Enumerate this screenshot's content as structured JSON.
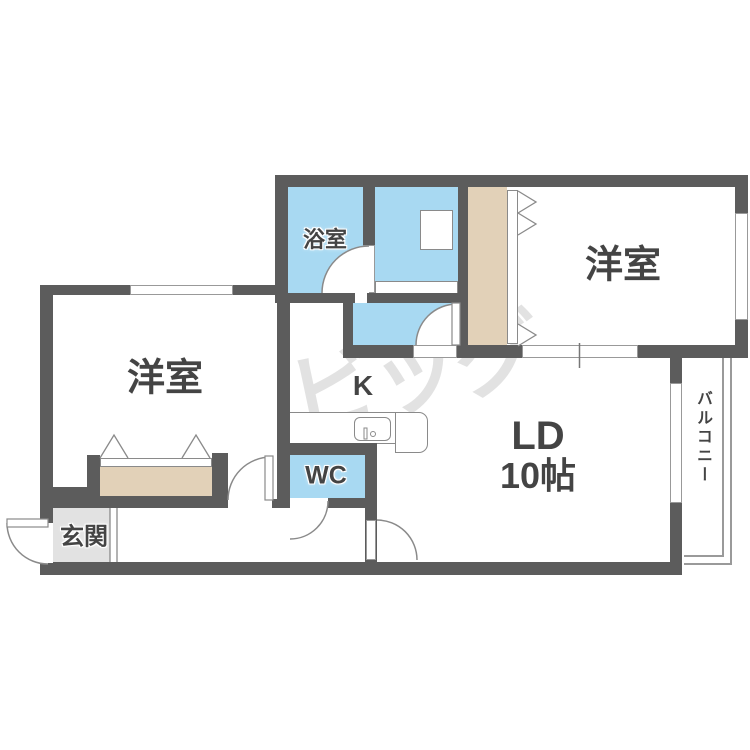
{
  "rooms": {
    "bath": {
      "label": "浴室"
    },
    "bedroom_top": {
      "label": "洋室"
    },
    "bedroom_left": {
      "label": "洋室"
    },
    "kitchen": {
      "label": "K"
    },
    "wc": {
      "label": "WC"
    },
    "living": {
      "label": "LD",
      "area": "10帖"
    },
    "entrance": {
      "label": "玄関"
    },
    "balcony": {
      "label": "バルコニー"
    }
  },
  "watermark": {
    "text": "ビッグ"
  },
  "colors": {
    "wall": "#5c5c5c",
    "water_area_floor": "#a8d9f2",
    "closet": "#e2d1b8",
    "entrance_floor": "#e2e2e2",
    "thin_outline": "#8a8a8a",
    "label_text": "#444444",
    "watermark": "#e2e2e2",
    "background": "#ffffff"
  }
}
